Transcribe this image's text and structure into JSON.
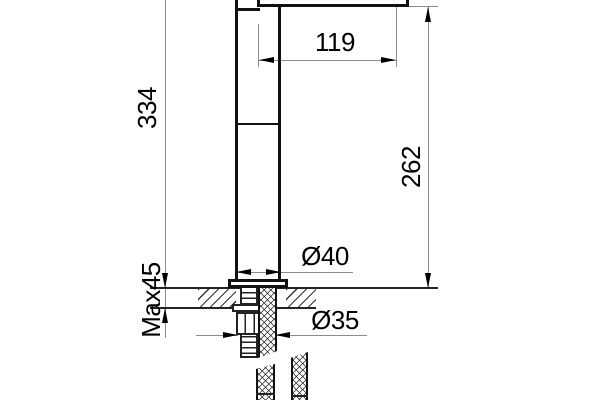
{
  "drawing": {
    "kind": "faucet installation dimension drawing",
    "units_implied": "mm",
    "dimensions": {
      "spout_reach": "119",
      "total_height": "334",
      "spout_height": "262",
      "body_diameter": "Ø40",
      "hole_diameter": "Ø35",
      "max_deck_thickness": "Max45"
    }
  }
}
